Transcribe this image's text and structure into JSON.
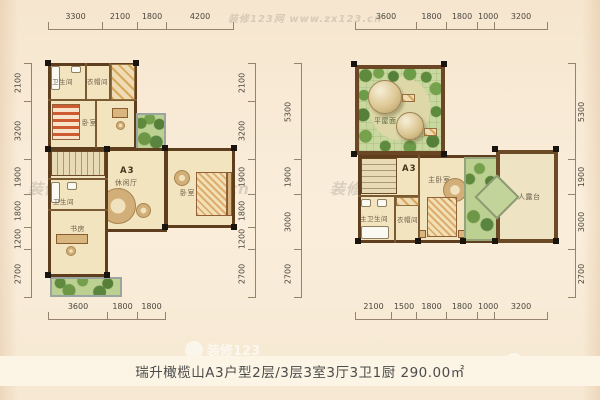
{
  "caption": "瑞升橄榄山A3户型2层/3层3室3厅3卫1厨 290.00㎡",
  "watermark": {
    "site": "装修123网 www.zx123.cn",
    "logo": "装修123"
  },
  "colors": {
    "wall": "#5e3e1d",
    "floor": "#f3e4c0",
    "green": "#bcd092",
    "background": "#f8e9d3"
  },
  "floor2": {
    "unit_label": "A3",
    "rooms": {
      "bath_top": "卫生间",
      "cloakroom": "衣帽间",
      "bedroom_left": "卧室",
      "lounge": "休闲厅",
      "bedroom_right": "卧室",
      "bath_lower": "卫生间",
      "study": "书房"
    },
    "dims": {
      "top": [
        "3300",
        "2100",
        "1800",
        "4200"
      ],
      "left": [
        "2100",
        "3200",
        "1900",
        "1800",
        "1200",
        "2700"
      ],
      "right": [
        "2100",
        "3200",
        "1900",
        "1800",
        "1200",
        "2700"
      ],
      "bottom": [
        "3600",
        "1800",
        "1800"
      ]
    }
  },
  "floor3": {
    "unit_label": "A3",
    "rooms": {
      "roof": "平屋面",
      "master_bedroom": "主卧室",
      "master_bath": "主卫生间",
      "cloakroom": "衣帽间",
      "terrace": "不上人露台"
    },
    "dims": {
      "top": [
        "3600",
        "1800",
        "1800",
        "1000",
        "3200"
      ],
      "left": [
        "5300",
        "1900",
        "3000",
        "2700"
      ],
      "right": [
        "5300",
        "1900",
        "3000",
        "2700"
      ],
      "bottom": [
        "2100",
        "1500",
        "1800",
        "1800",
        "1000",
        "3200"
      ]
    }
  }
}
